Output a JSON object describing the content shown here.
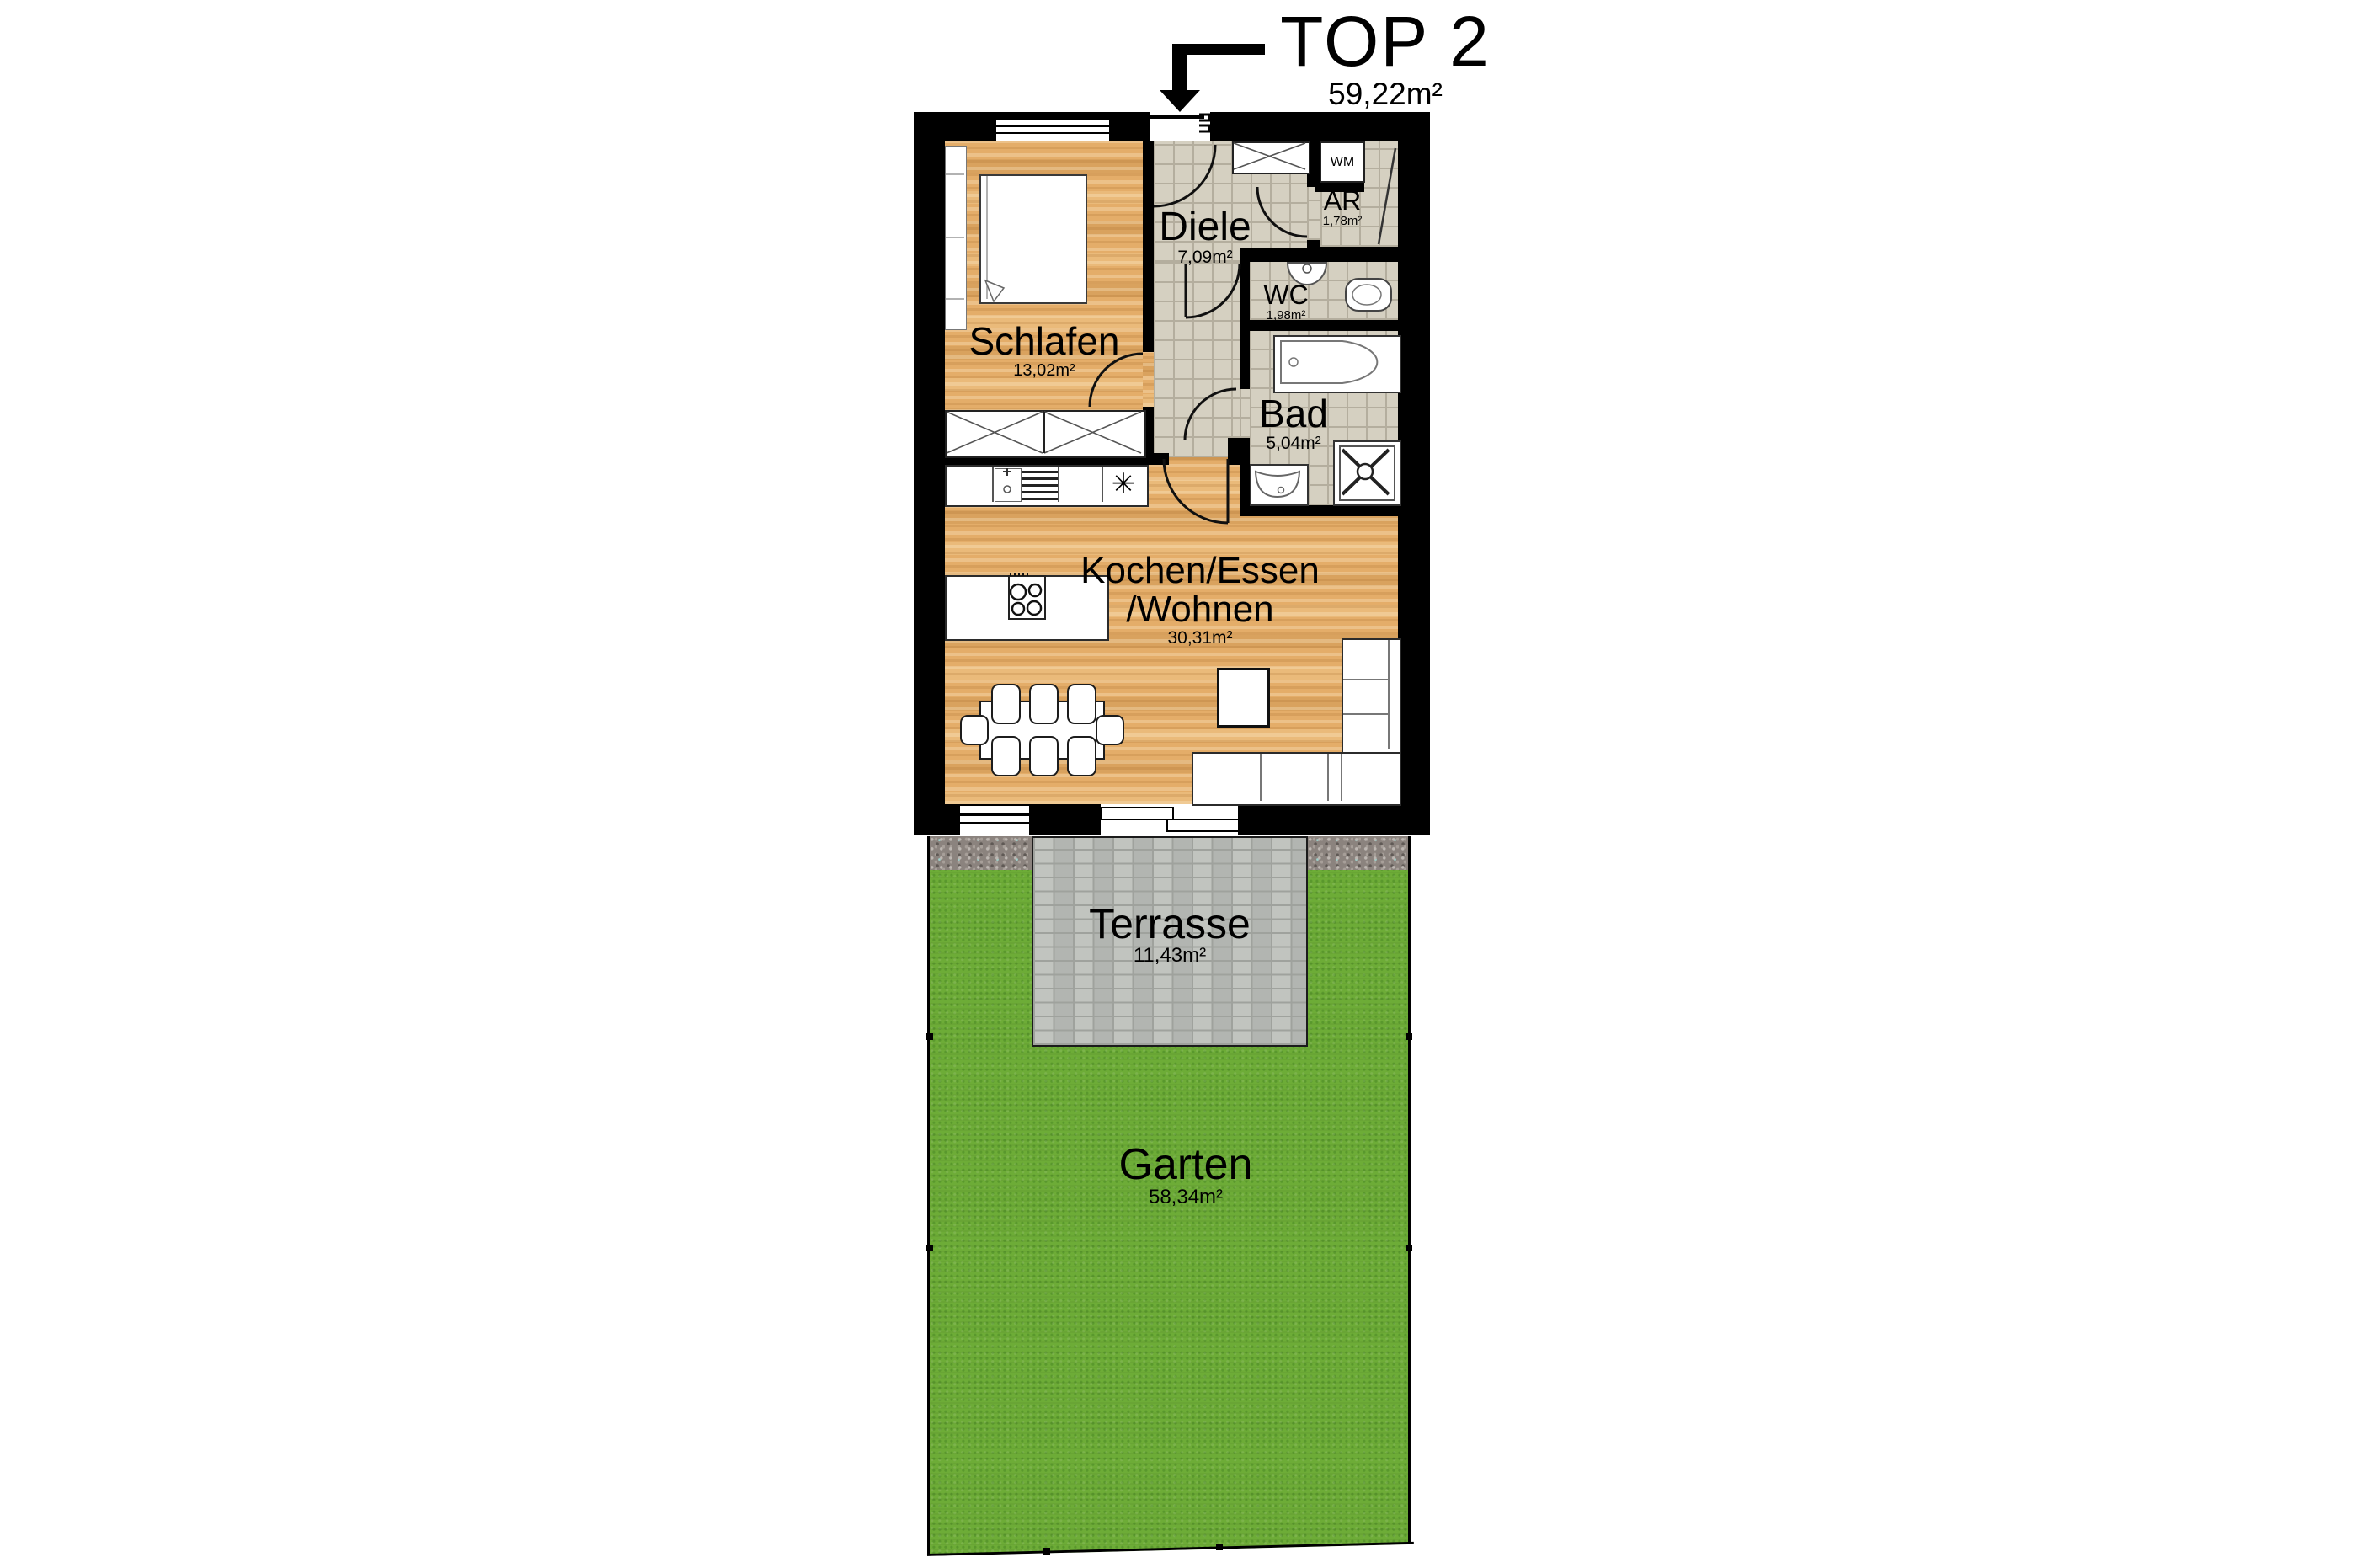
{
  "title": {
    "unit": "TOP 2",
    "area": "59,22m²"
  },
  "rooms": {
    "schlafen": {
      "name": "Schlafen",
      "area": "13,02m²"
    },
    "diele": {
      "name": "Diele",
      "area": "7,09m²"
    },
    "abstellraum": {
      "name": "AR",
      "area": "1,78m²"
    },
    "wc": {
      "name": "WC",
      "area": "1,98m²"
    },
    "bad": {
      "name": "Bad",
      "area": "5,04m²"
    },
    "wohnen": {
      "name_line1": "Kochen/Essen",
      "name_line2": "/Wohnen",
      "area": "30,31m²"
    },
    "terrasse": {
      "name": "Terrasse",
      "area": "11,43m²"
    },
    "garten": {
      "name": "Garten",
      "area": "58,34m²"
    }
  },
  "appliances": {
    "washing_machine": "WM",
    "fridge_symbol": "✳"
  },
  "colors": {
    "wall": "#000000",
    "wood": "#e4ad69",
    "tile": "#d5d0c1",
    "tile_line": "#b4ae9e",
    "terrace": "#bcbfba",
    "terrace_line": "#9fa29d",
    "grass": "#6dac37",
    "gravel": "#8b837e"
  }
}
